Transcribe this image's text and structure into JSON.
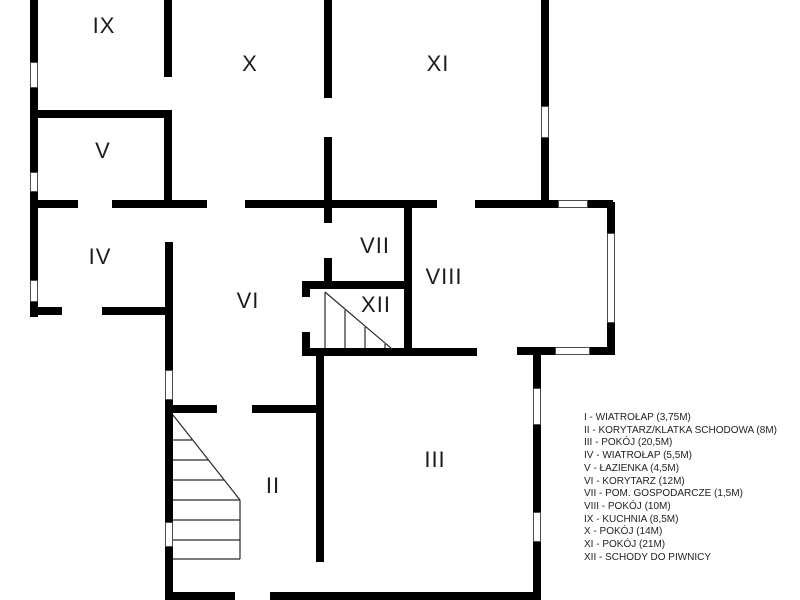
{
  "colors": {
    "wall": "#000000",
    "background": "#ffffff",
    "label_text": "#1c1c1c",
    "legend_text": "#1f1f1f"
  },
  "rooms": {
    "ix": "IX",
    "x": "X",
    "xi": "XI",
    "v": "V",
    "iv": "IV",
    "vi": "VI",
    "vii": "VII",
    "viii": "VIII",
    "xii": "XII",
    "ii": "II",
    "iii": "III"
  },
  "legend": {
    "items": [
      "I - WIATROŁAP (3,75M)",
      "II - KORYTARZ/KLATKA SCHODOWA (8M)",
      "III - POKÓJ (20,5M)",
      "IV - WIATROŁAP (5,5M)",
      "V - ŁAZIENKA (4,5M)",
      "VI - KORYTARZ (12M)",
      "VII - POM. GOSPODARCZE (1,5M)",
      "VIII - POKÓJ (10M)",
      "IX - KUCHNIA (8,5M)",
      "X - POKÓJ (14M)",
      "XI - POKÓJ (21M)",
      "XII - SCHODY DO PIWNICY"
    ]
  }
}
